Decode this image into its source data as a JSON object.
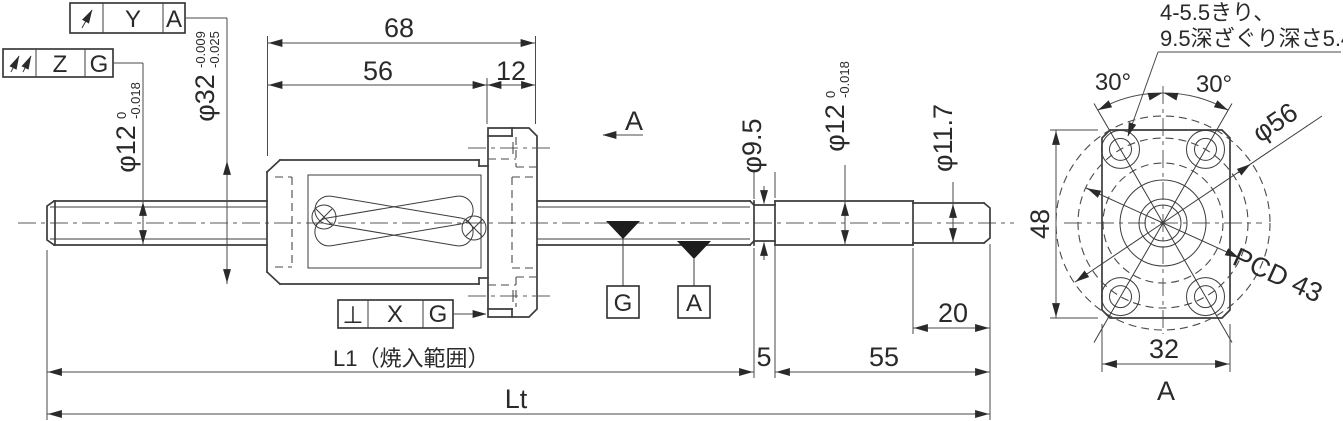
{
  "drawing": {
    "frames": {
      "runout": {
        "symbol_name": "circular-runout-arrow",
        "tolerance": "Y",
        "datum": "A"
      },
      "total_runout": {
        "symbol_name": "total-runout-arrows",
        "tolerance": "Z",
        "datum": "G"
      },
      "perpendicularity": {
        "symbol": "⊥",
        "tolerance": "X",
        "datum": "G"
      }
    },
    "datum_targets": {
      "g": "G",
      "a": "A"
    },
    "section": {
      "arrow_label": "A",
      "view_label": "A"
    },
    "dims": {
      "d68": "68",
      "d56": "56",
      "d12": "12",
      "phi32": {
        "v": "φ32",
        "tol_u": "-0.009",
        "tol_l": "-0.025"
      },
      "phi12_left": {
        "v": "φ12",
        "tol_u": "0",
        "tol_l": "-0.018"
      },
      "phi95": "φ9.5",
      "phi12_right": {
        "v": "φ12",
        "tol_u": "0",
        "tol_l": "-0.018"
      },
      "phi117": "φ11.7",
      "l1": "L1（焼入範囲）",
      "d5": "5",
      "d55": "55",
      "d20": "20",
      "lt": "Lt",
      "d48": "48",
      "d32": "32",
      "pcd": "PCD 43",
      "phi56": "φ56",
      "angle_left": "30°",
      "angle_right": "30°"
    },
    "note": {
      "line1": "4-5.5きり、",
      "line2": "9.5深ざぐり深さ5.4"
    }
  }
}
